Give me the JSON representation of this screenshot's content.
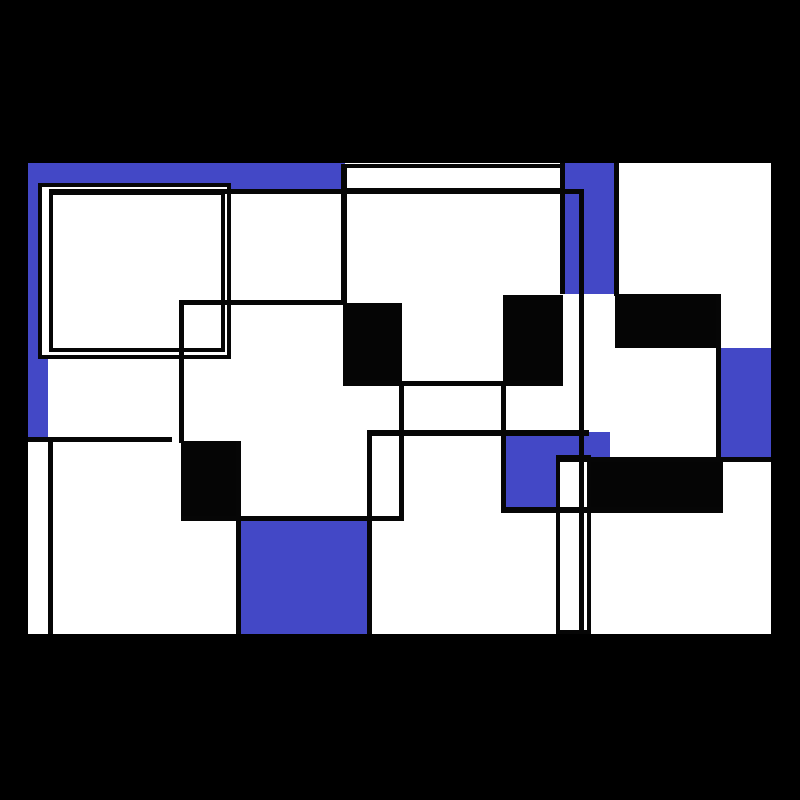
{
  "artwork": {
    "title": "abstract-geometric-composition",
    "palette": {
      "background": "#000000",
      "canvas_white": "#ffffff",
      "blue": "#4348c6",
      "ink": "#050505",
      "stroke": "#060606"
    },
    "stage": {
      "width": 800,
      "height": 800
    },
    "canvas": {
      "x": 28,
      "y": 163,
      "w": 743,
      "h": 471
    },
    "stroke_width": 4,
    "shapes": [
      {
        "name": "canvas-base",
        "type": "white-fill",
        "x": 28,
        "y": 163,
        "w": 743,
        "h": 471
      },
      {
        "name": "blue-top-band",
        "type": "blue-fill",
        "x": 28,
        "y": 163,
        "w": 317,
        "h": 28
      },
      {
        "name": "blue-left-band",
        "type": "blue-fill",
        "x": 28,
        "y": 163,
        "w": 20,
        "h": 274
      },
      {
        "name": "blue-mid-band",
        "type": "blue-fill",
        "x": 560,
        "y": 163,
        "w": 57,
        "h": 131
      },
      {
        "name": "blue-right-band",
        "type": "blue-fill",
        "x": 720,
        "y": 348,
        "w": 51,
        "h": 111
      },
      {
        "name": "blue-bottom-square",
        "type": "blue-fill",
        "x": 238,
        "y": 517,
        "w": 133,
        "h": 117
      },
      {
        "name": "outer-framed-square",
        "type": "bordered-white",
        "x": 38,
        "y": 183,
        "w": 193,
        "h": 176
      },
      {
        "name": "inner-frame-outline",
        "type": "outline",
        "x": 49,
        "y": 191,
        "w": 176,
        "h": 161
      },
      {
        "name": "white-top-strip",
        "type": "bordered-white",
        "x": 343,
        "y": 164,
        "w": 221,
        "h": 28
      },
      {
        "name": "blue-center-block",
        "type": "blue-fill",
        "x": 504,
        "y": 432,
        "w": 106,
        "h": 80
      },
      {
        "name": "black-bar-right-bottom",
        "type": "black-fill",
        "x": 589,
        "y": 459,
        "w": 134,
        "h": 54
      },
      {
        "name": "white-tall-rect",
        "type": "bordered-white",
        "x": 556,
        "y": 455,
        "w": 35,
        "h": 179
      },
      {
        "name": "black-square-center-left",
        "type": "black-fill",
        "x": 343,
        "y": 303,
        "w": 59,
        "h": 82
      },
      {
        "name": "black-square-center",
        "type": "black-fill",
        "x": 503,
        "y": 295,
        "w": 60,
        "h": 89
      },
      {
        "name": "black-bar-right-top",
        "type": "black-fill",
        "x": 615,
        "y": 294,
        "w": 101,
        "h": 54
      },
      {
        "name": "black-square-left",
        "type": "black-fill",
        "x": 181,
        "y": 441,
        "w": 57,
        "h": 76
      },
      {
        "name": "line-h-upper",
        "type": "line",
        "x": 49,
        "y": 189,
        "w": 532,
        "h": 5
      },
      {
        "name": "line-h-mid-left",
        "type": "line",
        "x": 179,
        "y": 300,
        "w": 166,
        "h": 5
      },
      {
        "name": "line-h-under-squares",
        "type": "line",
        "x": 343,
        "y": 381,
        "w": 220,
        "h": 5
      },
      {
        "name": "line-h-center",
        "type": "line",
        "x": 367,
        "y": 430,
        "w": 222,
        "h": 6
      },
      {
        "name": "line-h-left",
        "type": "line",
        "x": 28,
        "y": 437,
        "w": 144,
        "h": 5
      },
      {
        "name": "line-h-right",
        "type": "line",
        "x": 556,
        "y": 457,
        "w": 215,
        "h": 5
      },
      {
        "name": "line-h-lower-right",
        "type": "line",
        "x": 504,
        "y": 507,
        "w": 219,
        "h": 6
      },
      {
        "name": "line-h-lower-left",
        "type": "line",
        "x": 181,
        "y": 516,
        "w": 222,
        "h": 5
      },
      {
        "name": "line-v-top-left-col",
        "type": "line",
        "x": 341,
        "y": 164,
        "w": 6,
        "h": 141
      },
      {
        "name": "line-v-left",
        "type": "line",
        "x": 179,
        "y": 300,
        "w": 5,
        "h": 143
      },
      {
        "name": "line-v-center",
        "type": "line",
        "x": 399,
        "y": 383,
        "w": 5,
        "h": 138
      },
      {
        "name": "line-v-center-long",
        "type": "line",
        "x": 367,
        "y": 430,
        "w": 5,
        "h": 204
      },
      {
        "name": "line-v-center-right",
        "type": "line",
        "x": 501,
        "y": 383,
        "w": 5,
        "h": 130
      },
      {
        "name": "line-v-strip-right",
        "type": "line",
        "x": 560,
        "y": 163,
        "w": 5,
        "h": 131
      },
      {
        "name": "line-v-tall",
        "type": "line",
        "x": 579,
        "y": 189,
        "w": 5,
        "h": 445
      },
      {
        "name": "line-v-band-right",
        "type": "line",
        "x": 614,
        "y": 163,
        "w": 5,
        "h": 133
      },
      {
        "name": "line-v-far-right",
        "type": "line",
        "x": 716,
        "y": 294,
        "w": 5,
        "h": 165
      },
      {
        "name": "line-v-bottom-left",
        "type": "line",
        "x": 236,
        "y": 441,
        "w": 5,
        "h": 193
      },
      {
        "name": "line-v-left-edge",
        "type": "line",
        "x": 48,
        "y": 437,
        "w": 5,
        "h": 197
      }
    ]
  }
}
